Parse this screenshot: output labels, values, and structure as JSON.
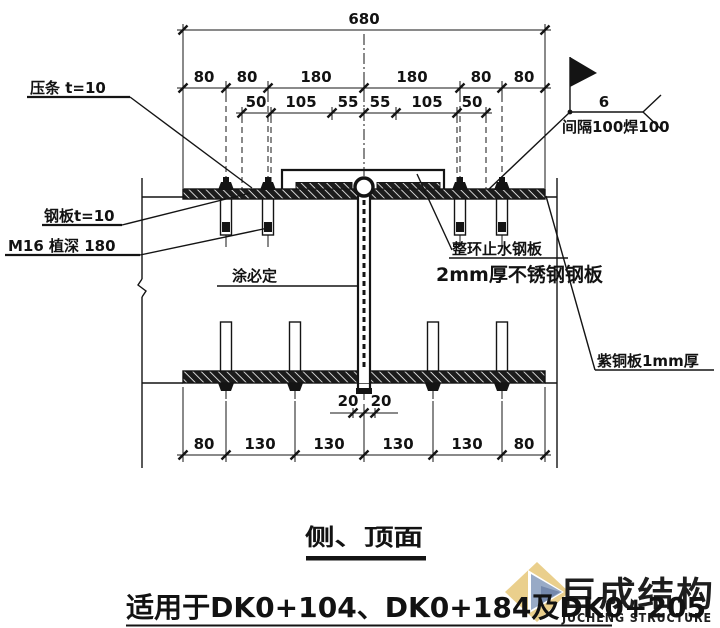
{
  "dims": {
    "total": "680",
    "row2": [
      "80",
      "80",
      "180",
      "180",
      "80",
      "80"
    ],
    "row3": [
      "50",
      "105",
      "55",
      "55",
      "105",
      "50"
    ],
    "bottom": [
      "80",
      "130",
      "130",
      "130",
      "130",
      "80"
    ],
    "joint": [
      "20",
      "20"
    ],
    "weld_size": "6"
  },
  "labels": {
    "pressure_strip": "压条 t=10",
    "steel_plate": "钢板t=10",
    "anchor": "M16 植深 180",
    "sealant": "涂必定",
    "weld_note": "间隔100焊100",
    "waterstop1": "整环止水钢板",
    "waterstop2": "2mm厚不锈钢钢板",
    "copper": "紫铜板1mm厚"
  },
  "title": "侧、顶面",
  "applicability": "适用于DK0+104、DK0+184及DK0+205",
  "watermark": {
    "cn": "巨成结构",
    "en": "JUCHENG STRUCTURE"
  },
  "colors": {
    "line": "#141414",
    "wm_orange": "#eeb493",
    "wm_blue": "#b7c3d9",
    "logo_yellow": "#e9cd86",
    "logo_blue": "#93a6c4",
    "logo_dark": "#6d82a8"
  }
}
